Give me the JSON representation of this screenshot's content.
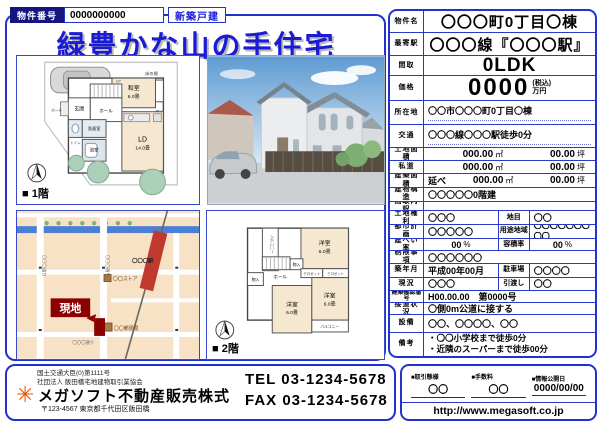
{
  "colors": {
    "frame_blue": "#2233cc",
    "title_blue": "#1b1bd6",
    "badge_navy": "#14157e",
    "site_red": "#8b0000",
    "station_red": "#c0392f",
    "logo_orange": "#e85700"
  },
  "header": {
    "property_no_label": "物件番号",
    "property_no_value": "0000000000",
    "property_type_badge": "新築戸建",
    "title": "緑豊かな山の手住宅"
  },
  "floor1": {
    "caption": "■ 1階",
    "rooms": {
      "washitsu": "和室",
      "washitsu_size": "6.0畳",
      "tokonoma": "床の間",
      "oshiire": "押入",
      "ld": "LD",
      "ld_size": "14.0畳",
      "genkan": "玄関",
      "porch": "ポーチ",
      "hall": "ホール",
      "up": "UP",
      "senmen": "洗面室",
      "yokushitsu": "浴室",
      "toilet": "トイレ"
    }
  },
  "floor2": {
    "caption": "■ 2階",
    "rooms": {
      "yoshitsu1": "洋室",
      "yoshitsu1_size": "6.0畳",
      "yoshitsu2": "洋室",
      "yoshitsu2_size": "6.0畳",
      "yoshitsu3": "洋室",
      "yoshitsu3_size": "6.0畳",
      "balcony1": "バルコニー",
      "balcony2": "バルコニー",
      "hall": "ホール",
      "monoire1": "物入",
      "monoire2": "物入",
      "closet1": "クロゼット",
      "closet2": "クロゼット"
    }
  },
  "map": {
    "site_label": "現地",
    "station_label": "〇〇〇駅",
    "store_label": "〇〇ストア",
    "post_office_label": "〇〇郵便局",
    "street_left": "〇〇〇通り",
    "street_center": "〇〇〇通り",
    "street_bottom": "〇〇〇通り"
  },
  "specs": {
    "name_label": "物件名",
    "name": "〇〇〇町0丁目〇棟",
    "station_label": "最寄駅",
    "station": "〇〇〇線『〇〇〇駅』",
    "layout_label": "間取",
    "layout": "0LDK",
    "price_label": "価格",
    "price": "0000",
    "price_tax": "(税込)",
    "price_unit": "万円",
    "address_label": "所在地",
    "address": "〇〇市〇〇〇町0丁目〇棟",
    "access_label": "交通",
    "access": "〇〇〇線〇〇〇駅徒歩0分",
    "land_label": "土地面積",
    "land_m2": "000.00",
    "land_tsubo": "00.00",
    "road_label": "私道",
    "road_m2": "000.00",
    "road_tsubo": "00.00",
    "bldg_label": "建築面積",
    "bldg_prefix": "延べ",
    "bldg_m2": "000.00",
    "bldg_tsubo": "00.00",
    "m2_unit": "㎡",
    "tsubo_unit": "坪",
    "structure_label": "建物構造",
    "structure": "〇〇〇〇〇0階建",
    "layout_detail_label": "間取内訳",
    "layout_detail": "",
    "land_right_label": "土地権利",
    "land_right": "〇〇〇",
    "land_cat_label": "地目",
    "land_cat": "〇〇",
    "city_plan_label": "都市計画",
    "city_plan": "〇〇〇〇〇",
    "use_district_label": "用途地域",
    "use_district": "〇〇〇〇〇〇〇〇〇",
    "bcr_label": "建ぺい率",
    "bcr": "00",
    "bcr_unit": "%",
    "far_label": "容積率",
    "far": "00",
    "far_unit": "%",
    "restriction_label": "制限事項",
    "restriction": "〇〇〇〇〇〇",
    "built_label": "築年月",
    "built": "平成00年00月",
    "parking_label": "駐車場",
    "parking": "〇〇〇〇",
    "status_label": "現況",
    "status": "〇〇〇",
    "handover_label": "引渡し",
    "handover": "〇〇",
    "confirm_label": "建築確認番号",
    "confirm_no": "H00.00.00　第0000号",
    "road_access_label": "接道状況",
    "road_access": "〇側0m公道に接する",
    "equipment_label": "設備",
    "equipment": "〇〇、〇〇〇〇、〇〇",
    "remarks_label": "備考",
    "remarks_1": "・〇〇小学校まで徒歩0分",
    "remarks_2": "・近隣のスーパーまで徒歩00分"
  },
  "footer": {
    "license_1": "国土交通大臣(0)第1111号",
    "license_2": "社団法人 飯田橋宅地建物取引業協会",
    "logo_glyph": "✳",
    "company": "メガソフト不動産販売株式",
    "address": "〒123-4567 東京都千代田区飯田橋",
    "tel_line": "TEL 03-1234-5678",
    "fax_line": "FAX 03-1234-5678",
    "deal_type_label": "■取引態様",
    "deal_type": "〇〇",
    "fee_label": "■手数料",
    "fee": "〇〇",
    "release_label": "■情報公開日",
    "release_date": "0000/00/00",
    "url": "http://www.megasoft.co.jp"
  }
}
